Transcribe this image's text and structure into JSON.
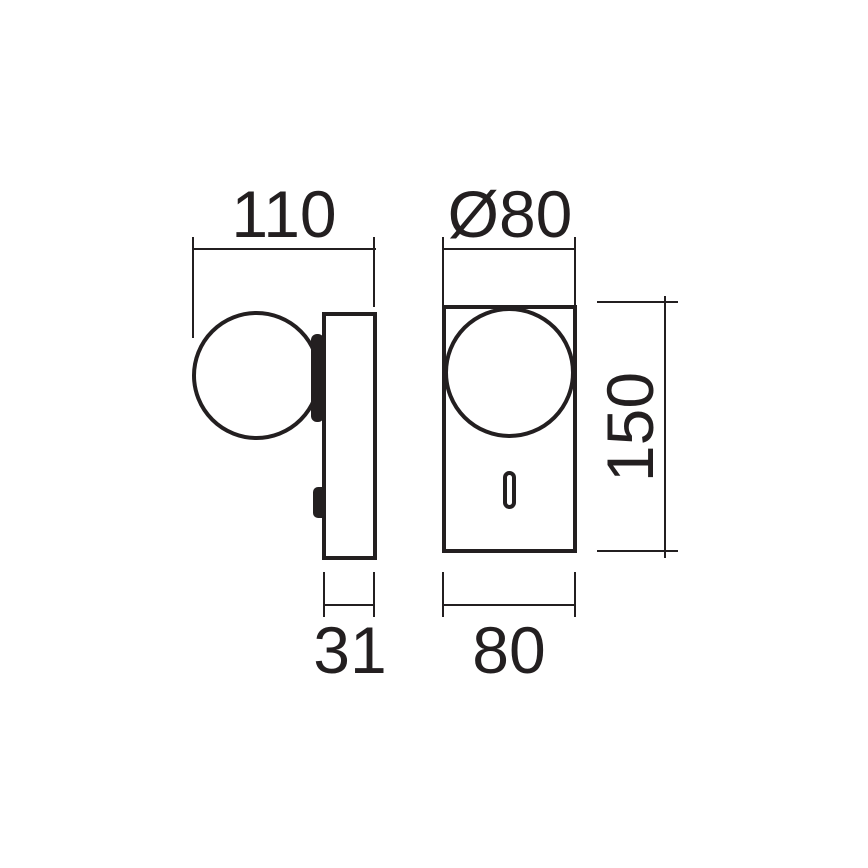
{
  "page": {
    "background": "#ffffff",
    "line_color": "#231f20"
  },
  "drawing": {
    "kind": "technical-dimension-drawing",
    "subject": "wall-light-two-views",
    "dimensions": {
      "overall_depth": {
        "label": "110"
      },
      "globe_diameter": {
        "label": "Ø80"
      },
      "body_height": {
        "label": "150"
      },
      "plate_depth": {
        "label": "31"
      },
      "body_width": {
        "label": "80"
      }
    }
  }
}
